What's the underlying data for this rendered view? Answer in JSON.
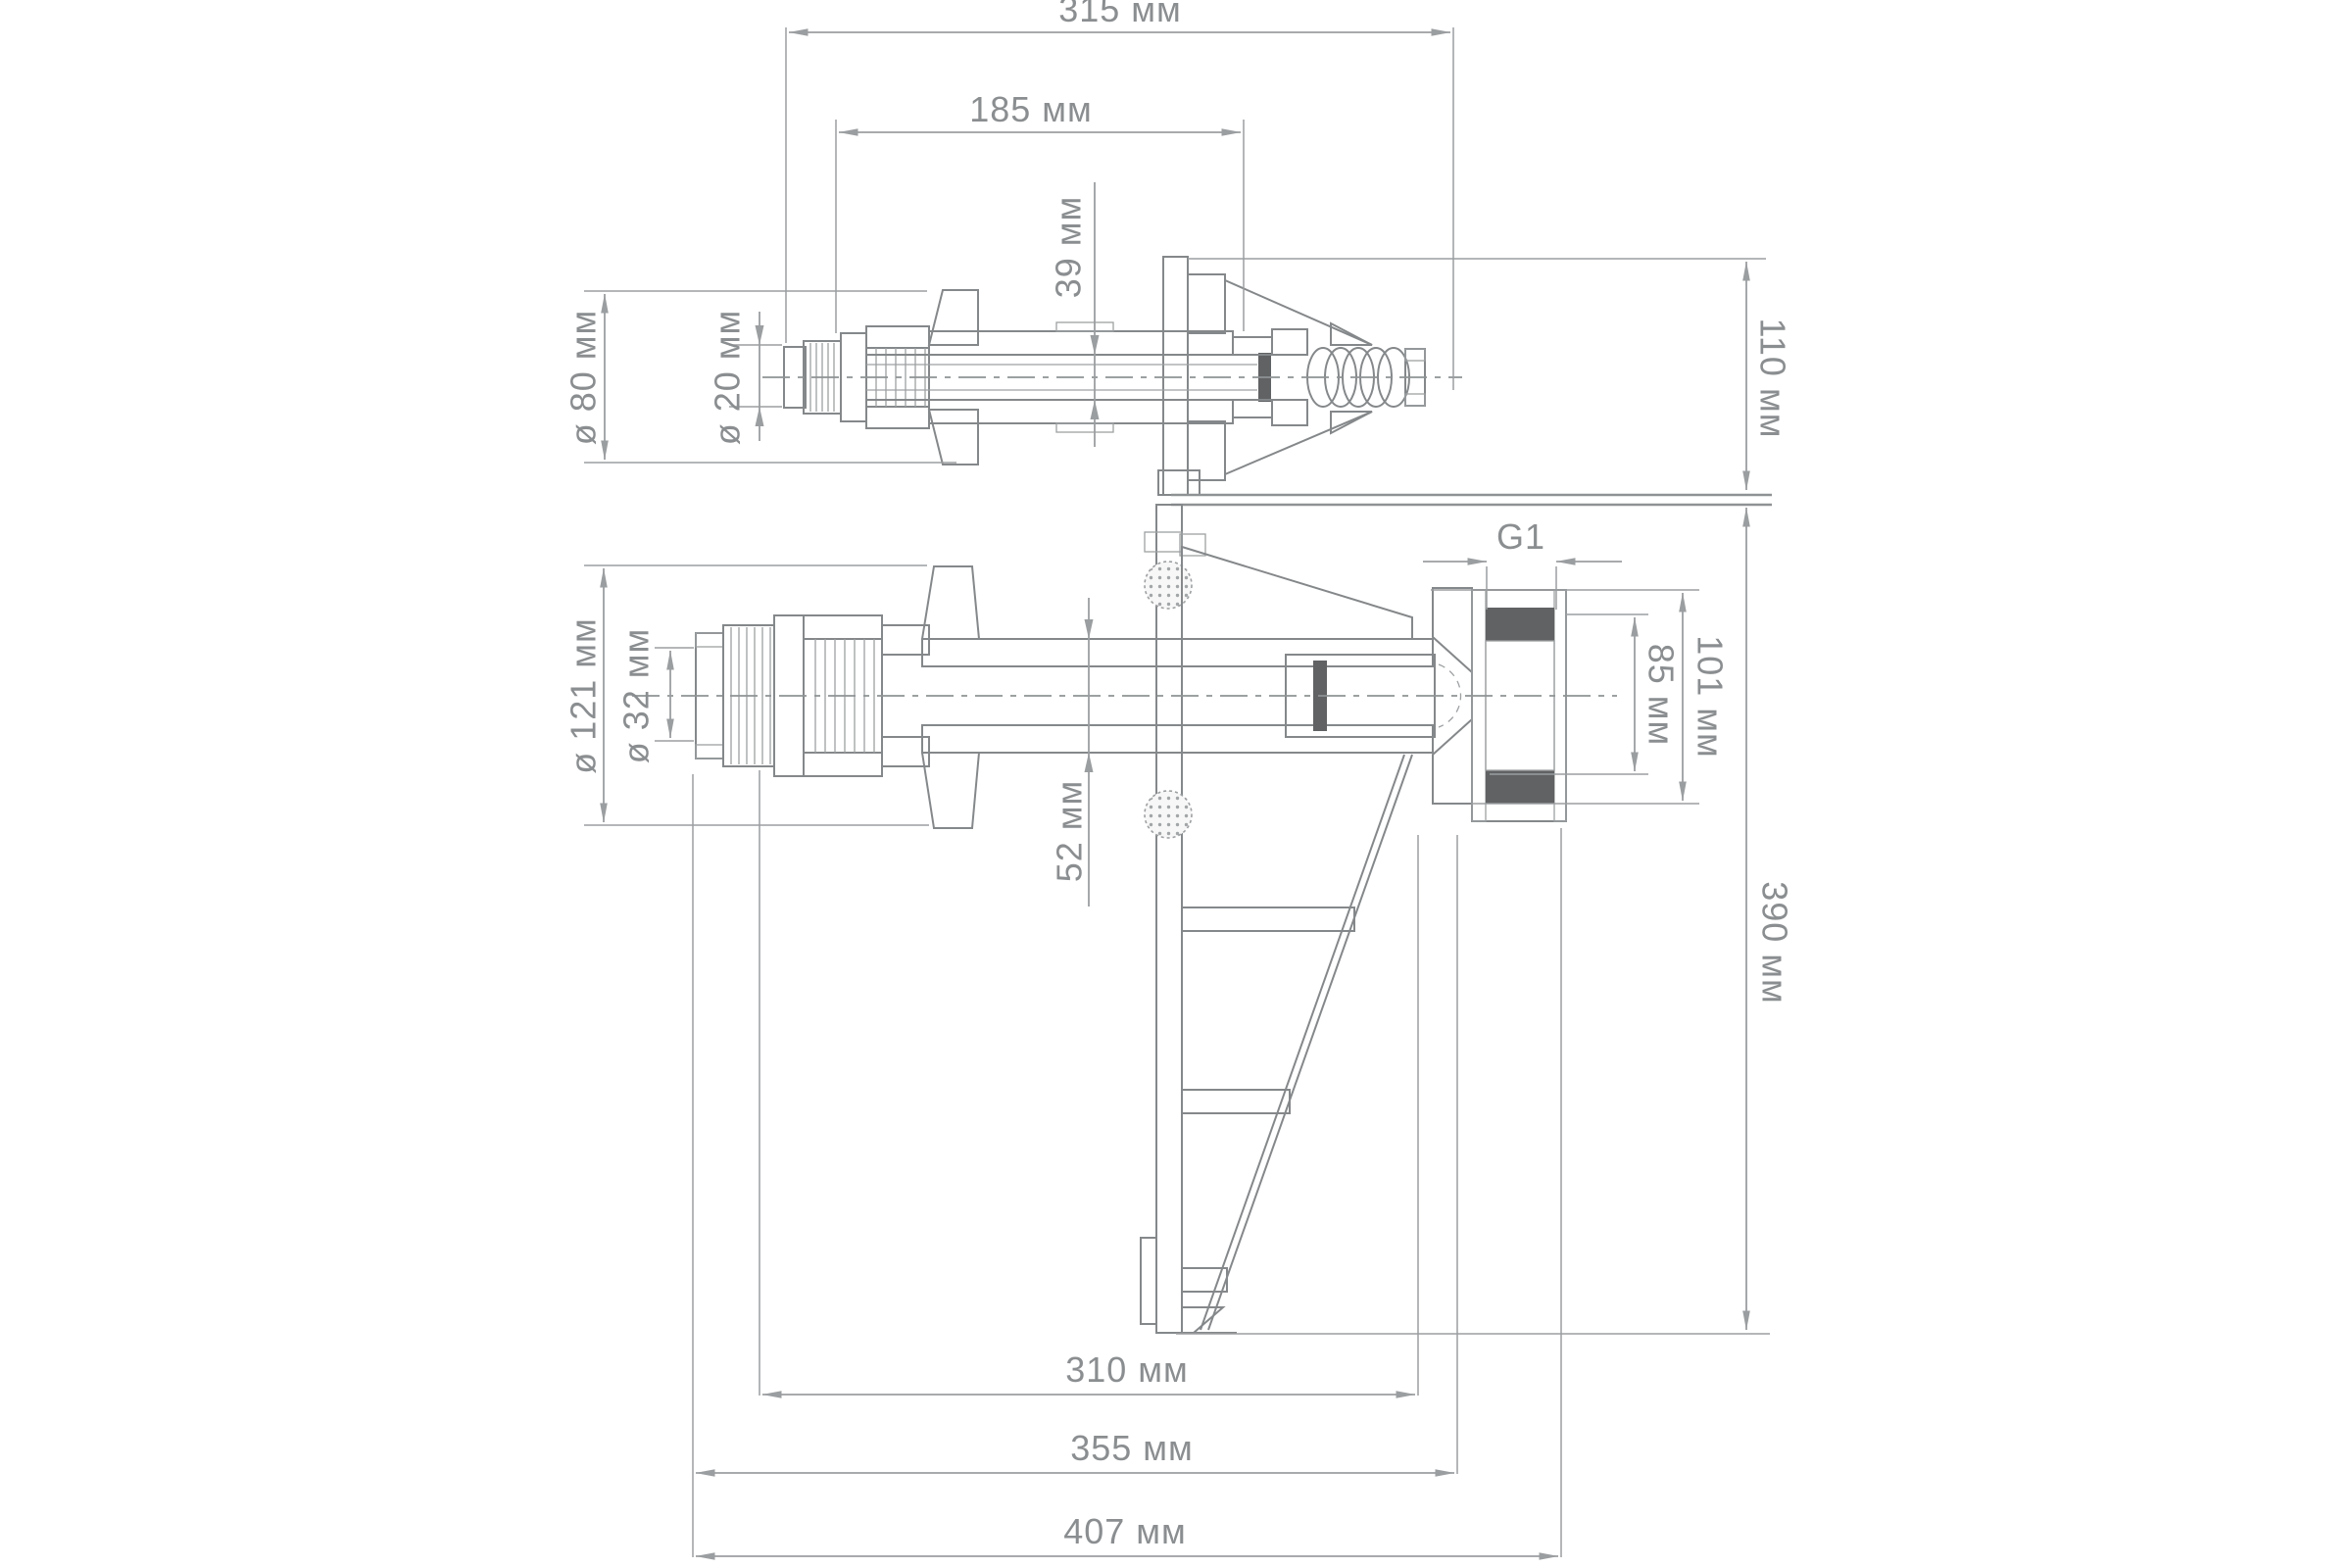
{
  "drawing": {
    "kind": "technical-dimension-drawing",
    "language": "ru",
    "colors": {
      "background": "#ffffff",
      "outline": "#85888a",
      "dimension_lines": "#9b9ea0",
      "text": "#8b8e90",
      "dark_fill": "#606264",
      "hatch": "#9da0a2"
    },
    "dims": {
      "d315": "315 мм",
      "d185": "185 мм",
      "d39": "39 мм",
      "d80": "ø 80 мм",
      "d20": "ø 20 мм",
      "d110": "110 мм",
      "g1": "G1",
      "d121": "ø 121 мм",
      "d32": "ø 32 мм",
      "d52": "52 мм",
      "d85": "85 мм",
      "d101": "101 мм",
      "d390": "390 мм",
      "d310": "310 мм",
      "d355": "355 мм",
      "d407": "407 мм"
    }
  }
}
